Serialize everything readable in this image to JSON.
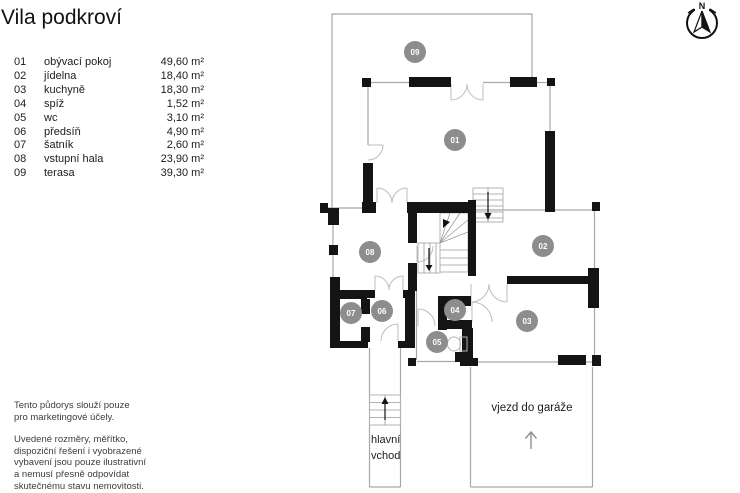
{
  "title": "Vila podkroví",
  "legend": {
    "rows": [
      {
        "num": "01",
        "name": "obývací pokoj",
        "area": "49,60 m²"
      },
      {
        "num": "02",
        "name": "jídelna",
        "area": "18,40 m²"
      },
      {
        "num": "03",
        "name": "kuchyně",
        "area": "18,30 m²"
      },
      {
        "num": "04",
        "name": "spíž",
        "area": "1,52 m²"
      },
      {
        "num": "05",
        "name": "wc",
        "area": "3,10 m²"
      },
      {
        "num": "06",
        "name": "předsíň",
        "area": "4,90 m²"
      },
      {
        "num": "07",
        "name": "šatník",
        "area": "2,60 m²"
      },
      {
        "num": "08",
        "name": "vstupní hala",
        "area": "23,90 m²"
      },
      {
        "num": "09",
        "name": "terasa",
        "area": "39,30 m²"
      }
    ]
  },
  "disclaimer": {
    "p1": [
      "Tento půdorys slouží pouze",
      "pro marketingové účely."
    ],
    "p2": [
      "Uvedené rozměry, měřítko,",
      "dispoziční řešení i vyobrazené",
      "vybavení jsou pouze ilustrativní",
      "a nemusí přesně odpovídat",
      "skutečnému stavu nemovitosti."
    ]
  },
  "plan": {
    "rooms": {
      "r01": "01",
      "r02": "02",
      "r03": "03",
      "r04": "04",
      "r05": "05",
      "r06": "06",
      "r07": "07",
      "r08": "08",
      "r09": "09"
    },
    "labels": {
      "main_entrance_line1": "hlavní",
      "main_entrance_line2": "vchod",
      "garage": "vjezd do garáže"
    },
    "compass_n": "N"
  },
  "colors": {
    "wall": "#141414",
    "thin_line": "#a8a8a8",
    "room_badge": "#8d8d8d",
    "badge_text": "#ffffff"
  }
}
